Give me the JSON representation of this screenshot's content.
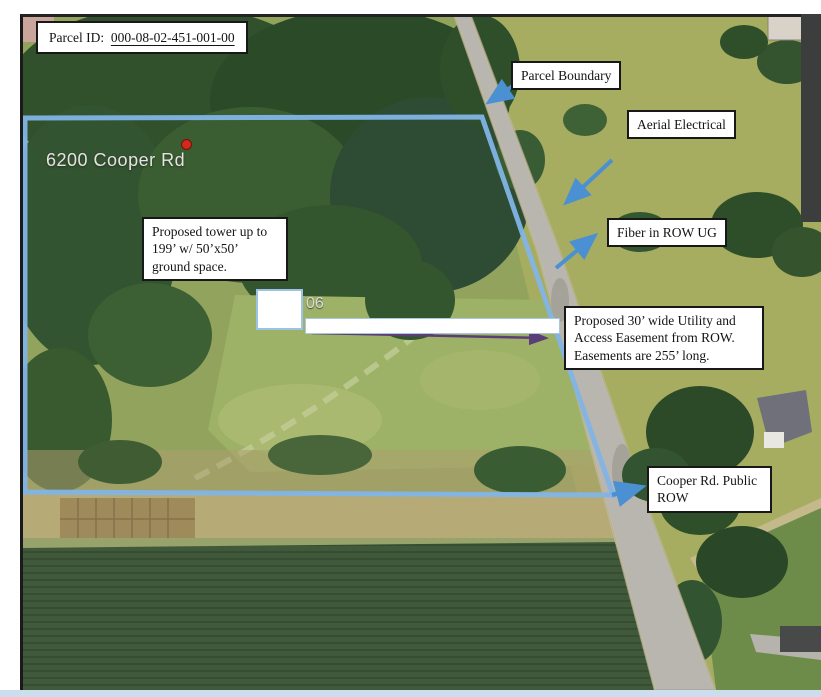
{
  "annotations": {
    "parcel_id": {
      "label": "Parcel ID:",
      "value": "000-08-02-451-001-00"
    },
    "parcel_boundary": {
      "label": "Parcel Boundary"
    },
    "aerial_electrical": {
      "label": "Aerial Electrical"
    },
    "fiber_row_ug": {
      "label": "Fiber in ROW UG"
    },
    "proposed_tower": {
      "label": "Proposed tower up to 199’ w/ 50’x50’ ground space."
    },
    "utility_easement": {
      "label": "Proposed 30’ wide Utility and Access Easement from ROW. Easements are 255’ long."
    },
    "cooper_rd_row": {
      "label": "Cooper Rd. Public ROW"
    }
  },
  "map_labels": {
    "address": "6200 Cooper Rd",
    "address_partial": "06"
  },
  "colors": {
    "boundary_blue": "#82b4e6",
    "arrow_blue": "#4a90d2",
    "easement_arrow_purple": "#5b3e78",
    "label_border": "#181818",
    "pad_border": "#9cc2e5",
    "road_gray": "#b8b6ae",
    "pin_red": "#d3281c",
    "bottom_bar": "#ccdded"
  }
}
